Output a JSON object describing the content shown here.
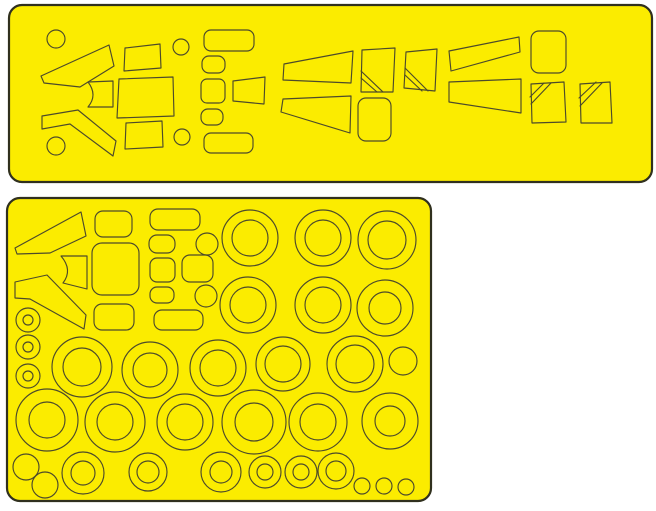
{
  "image": {
    "width": 656,
    "height": 511,
    "background": "#ffffff"
  },
  "colors": {
    "sheet_fill": "#fbec00",
    "cut_line": "#4c4a2b",
    "sheet_border": "#30301e",
    "background": "#ffffff"
  },
  "sheets": [
    {
      "name": "canopy-mask-sheet",
      "x": 9,
      "y": 5,
      "w": 643,
      "h": 177,
      "rx": 13,
      "shapes": [
        {
          "t": "circle",
          "n": "small-disc-mask",
          "cx": 56,
          "cy": 39,
          "r": 9
        },
        {
          "t": "poly",
          "n": "windshield-quarter-mask",
          "pts": [
            [
              41,
              76
            ],
            [
              109,
              45
            ],
            [
              114,
              66
            ],
            [
              80,
              87
            ],
            [
              44,
              83
            ]
          ]
        },
        {
          "t": "path",
          "n": "center-pane-mask",
          "d": "M88,82 Q98,95 88,107 L113,107 L113,81 Z"
        },
        {
          "t": "poly",
          "n": "windshield-quarter-mask",
          "pts": [
            [
              42,
              116
            ],
            [
              78,
              110
            ],
            [
              116,
              141
            ],
            [
              113,
              156
            ],
            [
              70,
              124
            ],
            [
              42,
              129
            ]
          ]
        },
        {
          "t": "circle",
          "n": "small-disc-mask",
          "cx": 56,
          "cy": 146,
          "r": 9
        },
        {
          "t": "poly",
          "n": "canopy-pane-mask",
          "pts": [
            [
              125,
              48
            ],
            [
              160,
              44
            ],
            [
              161,
              68
            ],
            [
              124,
              71
            ]
          ]
        },
        {
          "t": "poly",
          "n": "canopy-pane-mask",
          "pts": [
            [
              119,
              79
            ],
            [
              173,
              77
            ],
            [
              174,
              116
            ],
            [
              117,
              118
            ]
          ]
        },
        {
          "t": "poly",
          "n": "canopy-pane-mask",
          "pts": [
            [
              126,
              123
            ],
            [
              162,
              121
            ],
            [
              163,
              147
            ],
            [
              125,
              149
            ]
          ]
        },
        {
          "t": "circle",
          "n": "small-disc-mask",
          "cx": 181,
          "cy": 47,
          "r": 8
        },
        {
          "t": "circle",
          "n": "small-disc-mask",
          "cx": 182,
          "cy": 137,
          "r": 8
        },
        {
          "t": "rect",
          "n": "canopy-pane-mask",
          "x": 204,
          "y": 30,
          "w": 50,
          "h": 21,
          "rx": 7
        },
        {
          "t": "rect",
          "n": "canopy-pane-mask",
          "x": 202,
          "y": 56,
          "w": 23,
          "h": 17,
          "rx": 7
        },
        {
          "t": "rect",
          "n": "canopy-pane-mask",
          "x": 201,
          "y": 79,
          "w": 24,
          "h": 24,
          "rx": 6
        },
        {
          "t": "poly",
          "n": "canopy-pane-mask",
          "pts": [
            [
              233,
              81
            ],
            [
              265,
              77
            ],
            [
              264,
              104
            ],
            [
              233,
              101
            ]
          ]
        },
        {
          "t": "rect",
          "n": "canopy-pane-mask",
          "x": 201,
          "y": 109,
          "w": 22,
          "h": 16,
          "rx": 7
        },
        {
          "t": "rect",
          "n": "canopy-pane-mask",
          "x": 204,
          "y": 133,
          "w": 49,
          "h": 20,
          "rx": 7
        },
        {
          "t": "poly",
          "n": "side-window-wedge-mask",
          "pts": [
            [
              284,
              64
            ],
            [
              353,
              51
            ],
            [
              351,
              83
            ],
            [
              283,
              80
            ]
          ]
        },
        {
          "t": "poly",
          "n": "side-window-mask",
          "pts": [
            [
              362,
              50
            ],
            [
              395,
              48
            ],
            [
              393,
              92
            ],
            [
              361,
              92
            ]
          ]
        },
        {
          "t": "line",
          "n": "frame-cut-line",
          "x1": 361,
          "y1": 71,
          "x2": 383,
          "y2": 92
        },
        {
          "t": "line",
          "n": "frame-cut-line",
          "x1": 361,
          "y1": 78,
          "x2": 377,
          "y2": 92
        },
        {
          "t": "poly",
          "n": "side-window-mask",
          "pts": [
            [
              406,
              52
            ],
            [
              437,
              49
            ],
            [
              435,
              91
            ],
            [
              404,
              88
            ]
          ]
        },
        {
          "t": "line",
          "n": "frame-cut-line",
          "x1": 405,
          "y1": 68,
          "x2": 428,
          "y2": 91
        },
        {
          "t": "line",
          "n": "frame-cut-line",
          "x1": 405,
          "y1": 75,
          "x2": 422,
          "y2": 91
        },
        {
          "t": "poly",
          "n": "side-window-wedge-mask",
          "pts": [
            [
              283,
              99
            ],
            [
              351,
              96
            ],
            [
              350,
              133
            ],
            [
              281,
              112
            ]
          ]
        },
        {
          "t": "rect",
          "n": "side-window-mask",
          "x": 358,
          "y": 98,
          "w": 33,
          "h": 43,
          "rx": 8
        },
        {
          "t": "poly",
          "n": "side-window-wedge-mask",
          "pts": [
            [
              449,
              51
            ],
            [
              519,
              37
            ],
            [
              520,
              52
            ],
            [
              451,
              71
            ]
          ]
        },
        {
          "t": "rect",
          "n": "side-window-mask",
          "x": 531,
          "y": 31,
          "w": 35,
          "h": 42,
          "rx": 8
        },
        {
          "t": "poly",
          "n": "side-window-wedge-mask",
          "pts": [
            [
              449,
              82
            ],
            [
              521,
              79
            ],
            [
              521,
              113
            ],
            [
              449,
              102
            ]
          ]
        },
        {
          "t": "poly",
          "n": "side-window-mask",
          "pts": [
            [
              531,
              84
            ],
            [
              564,
              82
            ],
            [
              566,
              122
            ],
            [
              532,
              123
            ]
          ]
        },
        {
          "t": "line",
          "n": "frame-cut-line",
          "x1": 530,
          "y1": 97,
          "x2": 544,
          "y2": 83
        },
        {
          "t": "line",
          "n": "frame-cut-line",
          "x1": 531,
          "y1": 104,
          "x2": 551,
          "y2": 83
        },
        {
          "t": "poly",
          "n": "side-window-mask",
          "pts": [
            [
              580,
              84
            ],
            [
              610,
              82
            ],
            [
              612,
              123
            ],
            [
              581,
              123
            ]
          ]
        },
        {
          "t": "line",
          "n": "frame-cut-line",
          "x1": 579,
          "y1": 98,
          "x2": 596,
          "y2": 82
        },
        {
          "t": "line",
          "n": "frame-cut-line",
          "x1": 580,
          "y1": 106,
          "x2": 602,
          "y2": 83
        }
      ]
    },
    {
      "name": "wheel-and-canopy-mask-sheet",
      "x": 7,
      "y": 198,
      "w": 424,
      "h": 303,
      "rx": 13,
      "shapes": [
        {
          "t": "poly",
          "n": "windshield-quarter-mask",
          "pts": [
            [
              15,
              248
            ],
            [
              81,
              212
            ],
            [
              86,
              236
            ],
            [
              50,
              253
            ],
            [
              17,
              254
            ]
          ]
        },
        {
          "t": "path",
          "n": "center-pane-mask",
          "d": "M61,256 L87,256 L87,289 L63,283 Q73,270 61,256 Z"
        },
        {
          "t": "poly",
          "n": "windshield-quarter-mask",
          "pts": [
            [
              15,
              282
            ],
            [
              47,
              275
            ],
            [
              86,
              315
            ],
            [
              84,
              329
            ],
            [
              30,
              299
            ],
            [
              15,
              298
            ]
          ]
        },
        {
          "t": "rect",
          "n": "canopy-pane-mask",
          "x": 95,
          "y": 211,
          "w": 37,
          "h": 26,
          "rx": 8
        },
        {
          "t": "rect",
          "n": "canopy-pane-mask",
          "x": 92,
          "y": 243,
          "w": 47,
          "h": 52,
          "rx": 10
        },
        {
          "t": "rect",
          "n": "canopy-pane-mask",
          "x": 94,
          "y": 304,
          "w": 40,
          "h": 26,
          "rx": 8
        },
        {
          "t": "rect",
          "n": "canopy-pane-mask",
          "x": 150,
          "y": 209,
          "w": 50,
          "h": 21,
          "rx": 8
        },
        {
          "t": "rect",
          "n": "canopy-pane-mask",
          "x": 149,
          "y": 235,
          "w": 26,
          "h": 18,
          "rx": 8
        },
        {
          "t": "circle",
          "n": "small-disc-mask",
          "cx": 207,
          "cy": 244,
          "r": 11
        },
        {
          "t": "rect",
          "n": "canopy-pane-mask",
          "x": 150,
          "y": 258,
          "w": 25,
          "h": 24,
          "rx": 7
        },
        {
          "t": "rect",
          "n": "canopy-pane-mask",
          "x": 182,
          "y": 255,
          "w": 31,
          "h": 27,
          "rx": 8
        },
        {
          "t": "rect",
          "n": "canopy-pane-mask",
          "x": 150,
          "y": 287,
          "w": 24,
          "h": 16,
          "rx": 7
        },
        {
          "t": "circle",
          "n": "small-disc-mask",
          "cx": 206,
          "cy": 296,
          "r": 11
        },
        {
          "t": "rect",
          "n": "canopy-pane-mask",
          "x": 154,
          "y": 310,
          "w": 49,
          "h": 20,
          "rx": 8
        },
        {
          "t": "ring",
          "n": "small-wheel-mask",
          "cx": 28,
          "cy": 320,
          "ro": 12,
          "ri": 5
        },
        {
          "t": "ring",
          "n": "small-wheel-mask",
          "cx": 28,
          "cy": 347,
          "ro": 12,
          "ri": 5
        },
        {
          "t": "ring",
          "n": "small-wheel-mask",
          "cx": 28,
          "cy": 376,
          "ro": 12,
          "ri": 5
        },
        {
          "t": "ring",
          "n": "wheel-mask",
          "cx": 250,
          "cy": 238,
          "ro": 28,
          "ri": 18
        },
        {
          "t": "ring",
          "n": "wheel-mask",
          "cx": 323,
          "cy": 238,
          "ro": 28,
          "ri": 18
        },
        {
          "t": "ring",
          "n": "wheel-mask",
          "cx": 387,
          "cy": 240,
          "ro": 29,
          "ri": 19
        },
        {
          "t": "ring",
          "n": "wheel-mask",
          "cx": 248,
          "cy": 305,
          "ro": 28,
          "ri": 18
        },
        {
          "t": "ring",
          "n": "wheel-mask",
          "cx": 323,
          "cy": 305,
          "ro": 28,
          "ri": 18
        },
        {
          "t": "ring",
          "n": "wheel-mask",
          "cx": 385,
          "cy": 308,
          "ro": 28,
          "ri": 16
        },
        {
          "t": "ring",
          "n": "wheel-mask",
          "cx": 82,
          "cy": 367,
          "ro": 30,
          "ri": 19
        },
        {
          "t": "ring",
          "n": "wheel-mask",
          "cx": 150,
          "cy": 370,
          "ro": 28,
          "ri": 17
        },
        {
          "t": "ring",
          "n": "wheel-mask",
          "cx": 218,
          "cy": 368,
          "ro": 28,
          "ri": 18
        },
        {
          "t": "ring",
          "n": "wheel-mask",
          "cx": 283,
          "cy": 364,
          "ro": 27,
          "ri": 18
        },
        {
          "t": "ring",
          "n": "wheel-mask",
          "cx": 355,
          "cy": 364,
          "ro": 28,
          "ri": 19
        },
        {
          "t": "circle",
          "n": "wheel-disc-mask",
          "cx": 403,
          "cy": 361,
          "r": 14
        },
        {
          "t": "ring",
          "n": "wheel-mask",
          "cx": 47,
          "cy": 420,
          "ro": 31,
          "ri": 18
        },
        {
          "t": "ring",
          "n": "wheel-mask",
          "cx": 115,
          "cy": 422,
          "ro": 30,
          "ri": 18
        },
        {
          "t": "ring",
          "n": "wheel-mask",
          "cx": 185,
          "cy": 422,
          "ro": 28,
          "ri": 18
        },
        {
          "t": "ring",
          "n": "wheel-mask",
          "cx": 254,
          "cy": 422,
          "ro": 32,
          "ri": 19
        },
        {
          "t": "ring",
          "n": "wheel-mask",
          "cx": 318,
          "cy": 422,
          "ro": 29,
          "ri": 18
        },
        {
          "t": "ring",
          "n": "wheel-mask",
          "cx": 390,
          "cy": 421,
          "ro": 28,
          "ri": 15
        },
        {
          "t": "circle",
          "n": "wheel-disc-mask",
          "cx": 26,
          "cy": 467,
          "r": 13
        },
        {
          "t": "circle",
          "n": "wheel-disc-mask",
          "cx": 45,
          "cy": 485,
          "r": 13
        },
        {
          "t": "ring",
          "n": "wheel-mask",
          "cx": 83,
          "cy": 473,
          "ro": 21,
          "ri": 12
        },
        {
          "t": "ring",
          "n": "wheel-mask",
          "cx": 148,
          "cy": 472,
          "ro": 19,
          "ri": 11
        },
        {
          "t": "ring",
          "n": "wheel-mask",
          "cx": 221,
          "cy": 472,
          "ro": 20,
          "ri": 11
        },
        {
          "t": "ring",
          "n": "wheel-mask",
          "cx": 265,
          "cy": 472,
          "ro": 16,
          "ri": 8
        },
        {
          "t": "ring",
          "n": "wheel-mask",
          "cx": 301,
          "cy": 472,
          "ro": 16,
          "ri": 8
        },
        {
          "t": "ring",
          "n": "wheel-mask",
          "cx": 336,
          "cy": 471,
          "ro": 18,
          "ri": 10
        },
        {
          "t": "circle",
          "n": "small-disc-mask",
          "cx": 362,
          "cy": 486,
          "r": 8
        },
        {
          "t": "circle",
          "n": "small-disc-mask",
          "cx": 384,
          "cy": 486,
          "r": 8
        },
        {
          "t": "circle",
          "n": "small-disc-mask",
          "cx": 406,
          "cy": 487,
          "r": 8
        }
      ]
    }
  ]
}
